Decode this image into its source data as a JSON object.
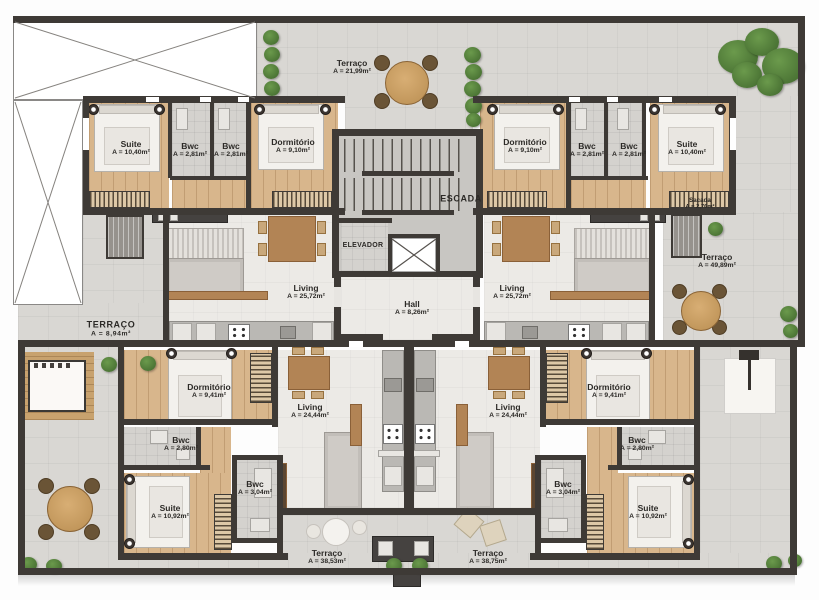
{
  "colors": {
    "wall": "#3e3a36",
    "pavement": "#d9d7d3",
    "wood_floor": "#d8b68c",
    "interior_floor": "#eceae6",
    "plant_green": "#4e7a38",
    "furniture_wood": "#b28455"
  },
  "core": {
    "escada": "ESCADA",
    "elevador": "ELEVADOR",
    "hall_name": "Hall",
    "hall_area": "A = 8,26m²"
  },
  "terraces": {
    "top": {
      "name": "Terraço",
      "area": "A = 21,99m²"
    },
    "right": {
      "name": "Terraço",
      "area": "A = 49,89m²"
    },
    "left": {
      "name": "TERRAÇO",
      "area": "A = 8,94m²"
    },
    "bottom_left": {
      "name": "Terraço",
      "area": "A = 38,53m²"
    },
    "bottom_right": {
      "name": "Terraço",
      "area": "A = 38,75m²"
    }
  },
  "units": {
    "top_left": {
      "suite_name": "Suite",
      "suite_area": "A = 10,40m²",
      "bwc1_name": "Bwc",
      "bwc1_area": "A = 2,81m²",
      "bwc2_name": "Bwc",
      "bwc2_area": "A = 2,81m²",
      "dorm_name": "Dormitório",
      "dorm_area": "A = 9,10m²",
      "living_name": "Living",
      "living_area": "A = 25,72m²"
    },
    "top_right": {
      "dorm_name": "Dormitório",
      "dorm_area": "A = 9,10m²",
      "bwc1_name": "Bwc",
      "bwc1_area": "A = 2,81m²",
      "bwc2_name": "Bwc",
      "bwc2_area": "A = 2,81m²",
      "suite_name": "Suite",
      "suite_area": "A = 10,40m²",
      "living_name": "Living",
      "living_area": "A = 25,72m²",
      "sacada_name": "Sacada",
      "sacada_area": "A = 2,76m²"
    },
    "bottom_left": {
      "dorm_name": "Dormitório",
      "dorm_area": "A = 9,41m²",
      "living_name": "Living",
      "living_area": "A = 24,44m²",
      "bwc_top_name": "Bwc",
      "bwc_top_area": "A = 2,80m²",
      "bwc_bottom_name": "Bwc",
      "bwc_bottom_area": "A = 3,04m²",
      "suite_name": "Suite",
      "suite_area": "A = 10,92m²"
    },
    "bottom_right": {
      "dorm_name": "Dormitório",
      "dorm_area": "A = 9,41m²",
      "living_name": "Living",
      "living_area": "A = 24,44m²",
      "bwc_top_name": "Bwc",
      "bwc_top_area": "A = 2,80m²",
      "bwc_bottom_name": "Bwc",
      "bwc_bottom_area": "A = 3,04m²",
      "suite_name": "Suite",
      "suite_area": "A = 10,92m²"
    }
  }
}
